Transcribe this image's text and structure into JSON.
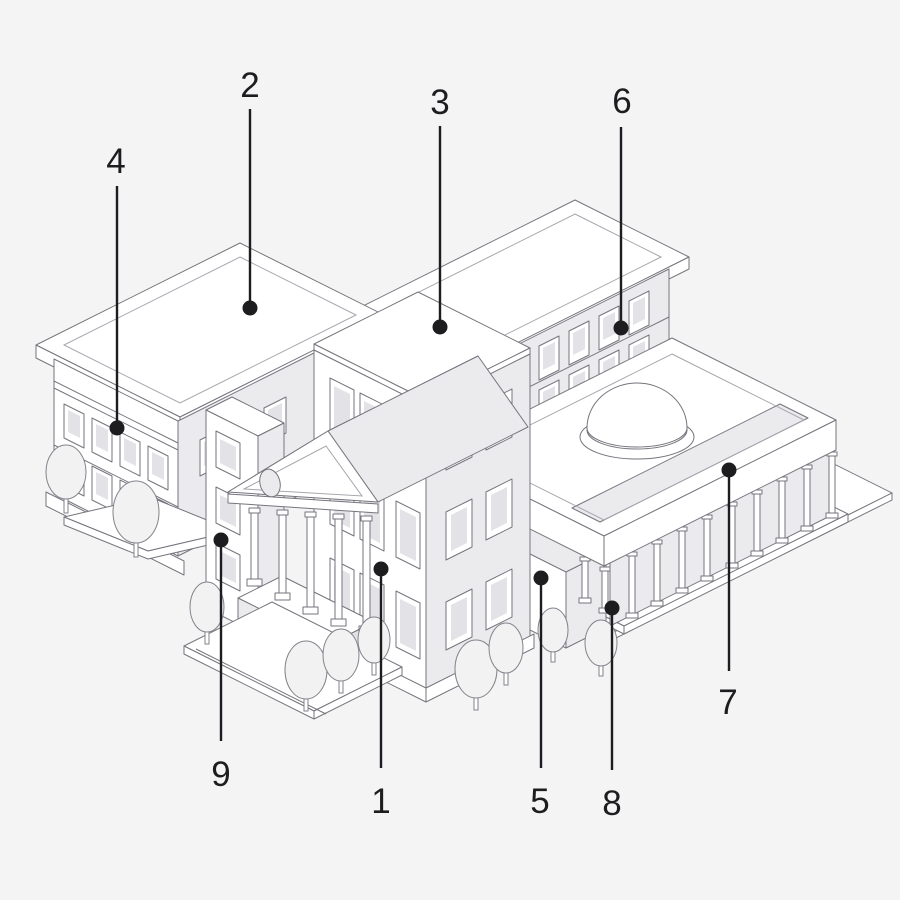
{
  "figure": {
    "kind": "isometric-campus-callout-diagram",
    "background_color": "#f4f4f5",
    "callout_color": "#1d1d20",
    "outline_color": "#75757d",
    "outline_light_color": "#a5a5ac",
    "face_white": "#ffffff",
    "face_shaded": "#ebebee",
    "face_shaded_dark": "#e2e2e6",
    "glass_color": "#e3e3e7",
    "tree_color": "#f2f2f3",
    "callouts": [
      {
        "number": "1"
      },
      {
        "number": "2"
      },
      {
        "number": "3"
      },
      {
        "number": "4"
      },
      {
        "number": "5"
      },
      {
        "number": "6"
      },
      {
        "number": "7"
      },
      {
        "number": "8"
      },
      {
        "number": "9"
      }
    ]
  }
}
